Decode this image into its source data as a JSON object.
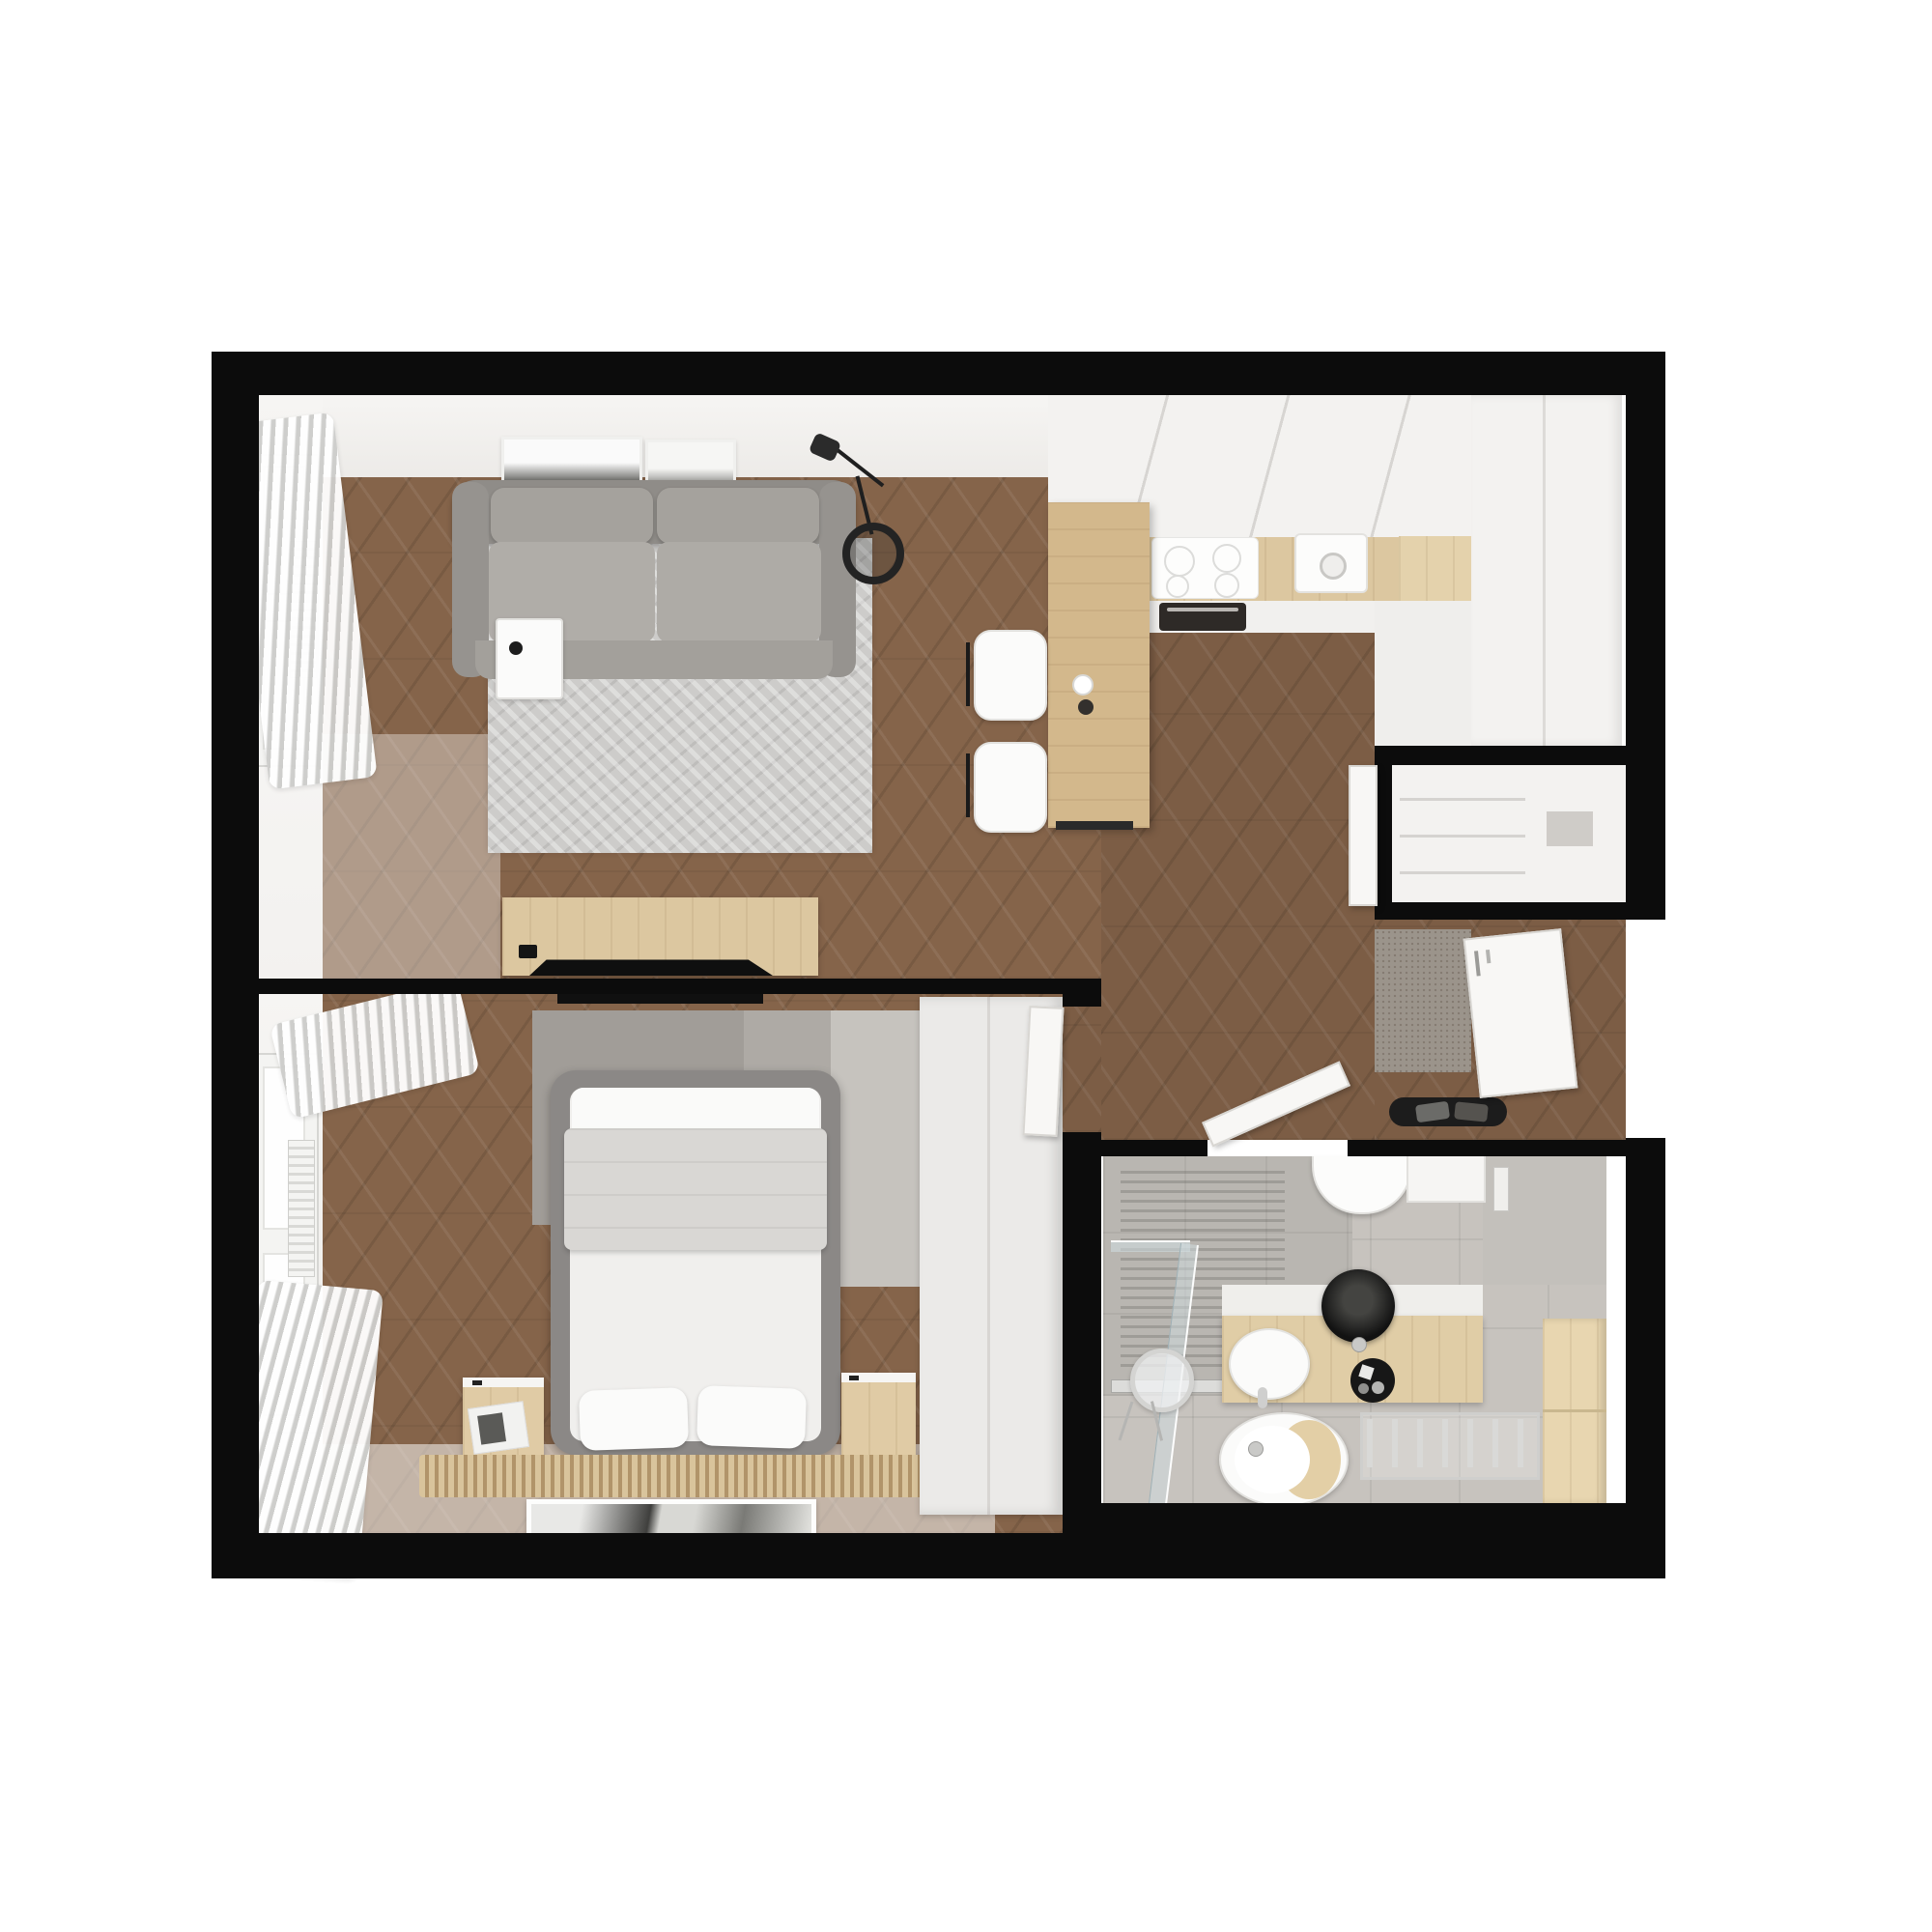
{
  "meta": {
    "title": "Studio apartment floor plan — top-down 3D render"
  },
  "colors": {
    "wall": "#0c0c0c",
    "wood-floor": "#85644a",
    "wood-light": "#dcc7a0",
    "wood-mid": "#d3b88c",
    "white-face": "#f4f3f1",
    "sofa-gray": "#a5a29d",
    "rug-living": "#cdccca",
    "tile": "#c7c3be",
    "shower-tile": "#b9b6b1",
    "accent-black": "#1a1a1a",
    "door-white": "#f8f7f5",
    "rug-bed-dark": "#a19d98",
    "rug-bed-light": "#c6c3be"
  },
  "rooms": {
    "living": {
      "label": "Living room"
    },
    "kitchen": {
      "label": "Kitchen"
    },
    "bedroom": {
      "label": "Bedroom"
    },
    "bathroom": {
      "label": "Bathroom"
    },
    "hall": {
      "label": "Hallway / entry"
    },
    "closet": {
      "label": "Storage closet"
    }
  },
  "furniture": {
    "sofa": "Gray fabric sofa",
    "rug_living": "Living room rug",
    "coffee_table": "White coffee table",
    "floor_lamp": "Black floor lamp",
    "tv_sideboard": "TV sideboard",
    "tv": "Television",
    "wall_art": "Wall art",
    "window": "Window",
    "curtain": "Curtains",
    "radiator": "Radiator",
    "upper_cabinets": "Kitchen upper cabinets",
    "countertop": "Kitchen countertop",
    "cooktop": "Induction cooktop",
    "sink": "Kitchen sink",
    "oven": "Built-in oven",
    "peninsula": "Kitchen peninsula counter",
    "bar_stool": "Bar stool",
    "coffee_cup": "Coffee cup",
    "tall_cabinets": "Tall kitchen cabinets",
    "closet_door": "Closet door",
    "doormat": "Entry doormat",
    "shoe_tray": "Shoe tray",
    "entry_door": "Entry door",
    "bathroom_door": "Bathroom door",
    "bedroom_door": "Bedroom door",
    "bed": "Double bed",
    "pillow": "Pillow",
    "blanket": "Folded blanket",
    "nightstand": "Nightstand",
    "wardrobe": "Wardrobe",
    "slat_runner": "Wood slat runner",
    "floor_art": "Framed picture",
    "rug_bedroom": "Bedroom rug",
    "shower": "Walk-in shower",
    "shower_glass": "Glass shower screen",
    "shower_drain": "Linear drain",
    "vanity": "Bathroom vanity",
    "vessel_basin": "Black vessel basin",
    "bathroom_sink": "Washbasin",
    "toilet": "Wall-hung toilet",
    "bidet": "Bidet with wood seat",
    "towel_radiator": "Towel radiator",
    "bathroom_mirror": "Round mirror",
    "bathroom_cabinet": "Bathroom side cabinet",
    "bathroom_accessories": "Toiletries"
  }
}
